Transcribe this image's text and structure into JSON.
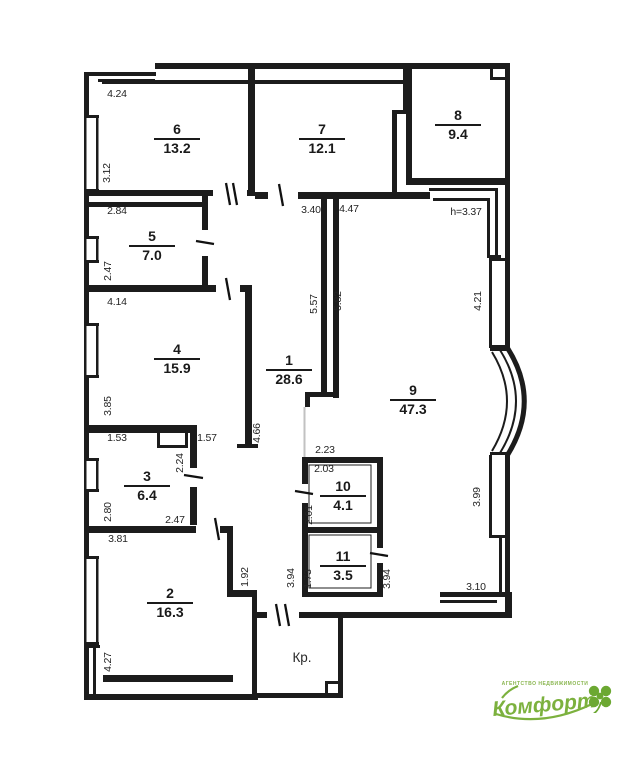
{
  "plan": {
    "porch_label": "Кр.",
    "rooms": [
      {
        "number": "6",
        "area": "13.2",
        "x": 177,
        "y": 139
      },
      {
        "number": "7",
        "area": "12.1",
        "x": 322,
        "y": 139
      },
      {
        "number": "8",
        "area": "9.4",
        "x": 458,
        "y": 125
      },
      {
        "number": "5",
        "area": "7.0",
        "x": 152,
        "y": 246
      },
      {
        "number": "4",
        "area": "15.9",
        "x": 177,
        "y": 359
      },
      {
        "number": "1",
        "area": "28.6",
        "x": 289,
        "y": 370
      },
      {
        "number": "9",
        "area": "47.3",
        "x": 413,
        "y": 400
      },
      {
        "number": "3",
        "area": "6.4",
        "x": 147,
        "y": 486
      },
      {
        "number": "10",
        "area": "4.1",
        "x": 343,
        "y": 496
      },
      {
        "number": "11",
        "area": "3.5",
        "x": 343,
        "y": 566
      },
      {
        "number": "2",
        "area": "16.3",
        "x": 170,
        "y": 603
      }
    ],
    "dimensions": [
      {
        "text": "4.24",
        "x": 117,
        "y": 97,
        "rot": 0
      },
      {
        "text": "3.12",
        "x": 110,
        "y": 173,
        "rot": -90
      },
      {
        "text": "2.84",
        "x": 117,
        "y": 214,
        "rot": 0
      },
      {
        "text": "3.40",
        "x": 311,
        "y": 213,
        "rot": 0
      },
      {
        "text": "4.47",
        "x": 349,
        "y": 212,
        "rot": 0
      },
      {
        "text": "h=3.37",
        "x": 466,
        "y": 215,
        "rot": 0
      },
      {
        "text": "2.47",
        "x": 111,
        "y": 271,
        "rot": -90
      },
      {
        "text": "4.14",
        "x": 117,
        "y": 305,
        "rot": 0
      },
      {
        "text": "5.57",
        "x": 317,
        "y": 304,
        "rot": -90
      },
      {
        "text": "5.82",
        "x": 341,
        "y": 301,
        "rot": -90
      },
      {
        "text": "4.21",
        "x": 481,
        "y": 301,
        "rot": -90
      },
      {
        "text": "3.85",
        "x": 111,
        "y": 406,
        "rot": -90
      },
      {
        "text": "1.53",
        "x": 117,
        "y": 441,
        "rot": 0
      },
      {
        "text": "1.57",
        "x": 207,
        "y": 441,
        "rot": 0
      },
      {
        "text": "4.66",
        "x": 260,
        "y": 433,
        "rot": -90
      },
      {
        "text": "2.23",
        "x": 325,
        "y": 453,
        "rot": 0
      },
      {
        "text": "2.03",
        "x": 324,
        "y": 472,
        "rot": 0
      },
      {
        "text": "2.24",
        "x": 183,
        "y": 463,
        "rot": -90
      },
      {
        "text": "2.80",
        "x": 111,
        "y": 512,
        "rot": -90
      },
      {
        "text": "2.47",
        "x": 175,
        "y": 523,
        "rot": 0
      },
      {
        "text": "2.01",
        "x": 312,
        "y": 515,
        "rot": -90
      },
      {
        "text": "3.99",
        "x": 480,
        "y": 497,
        "rot": -90
      },
      {
        "text": "3.81",
        "x": 118,
        "y": 542,
        "rot": 0
      },
      {
        "text": "1.92",
        "x": 248,
        "y": 577,
        "rot": -90
      },
      {
        "text": "3.94",
        "x": 294,
        "y": 578,
        "rot": -90
      },
      {
        "text": "1.73",
        "x": 311,
        "y": 579,
        "rot": -90
      },
      {
        "text": "3.94",
        "x": 390,
        "y": 579,
        "rot": -90
      },
      {
        "text": "3.10",
        "x": 476,
        "y": 590,
        "rot": 0
      },
      {
        "text": "4.27",
        "x": 111,
        "y": 662,
        "rot": -90
      }
    ]
  },
  "logo": {
    "brand": "Комфорт",
    "tagline": "агентство недвижимости",
    "accent_color": "#7cb13e"
  }
}
